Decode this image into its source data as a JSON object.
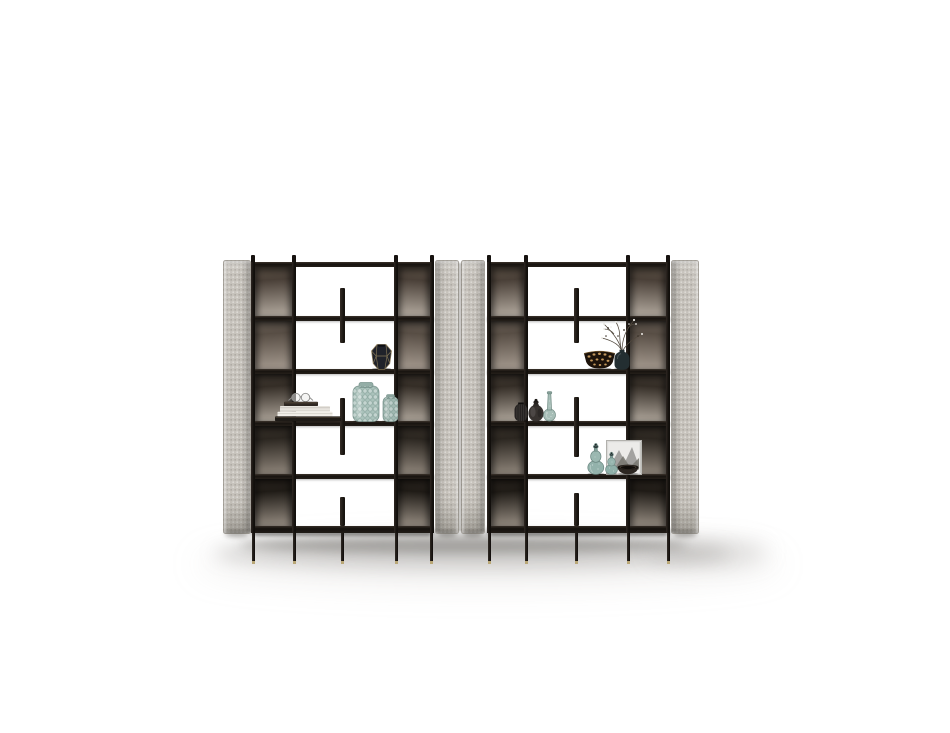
{
  "meta": {
    "description": "Product render on a white background: two tall open-shelf bookcase units with light grey upholstered side panels, black metal frames, smoked-bronze back panels and decorative objects on the shelves."
  },
  "palette": {
    "background": "#ffffff",
    "frame_black": "#1b1714",
    "shelf_dark": "#241f1a",
    "panel_gray": "#c9c5be",
    "panel_gray_edge": "#96928b",
    "leg_gold_tip": "#b9a776",
    "glass_teal": "#a7beb7",
    "bronze_dark": "#3a322a",
    "bronze_light": "#b5aca1"
  },
  "furniture": {
    "stage": {
      "width": 950,
      "height": 733
    },
    "shared": {
      "top_stub_y": 255,
      "beam_y": 262,
      "beam_h": 5,
      "shelf_ys": [
        316,
        369,
        421,
        474
      ],
      "shelf_h": 5,
      "bottom_shelf_y": 526,
      "bottom_shelf_h": 7,
      "panel_top": 260,
      "panel_bottom": 534,
      "leg_top": 533,
      "leg_h": 28,
      "leg_w": 3,
      "tip_h": 2.5,
      "bronze_rows": [
        {
          "from": "#6a5d50",
          "mid": "#4a4038",
          "to": "#b7aea3"
        },
        {
          "from": "#756a5f",
          "mid": "#584e45",
          "to": "#a89d92"
        },
        {
          "from": "#4a4138",
          "mid": "#352e27",
          "to": "#b4aba0"
        },
        {
          "from": "#403830",
          "mid": "#2c2721",
          "to": "#948a7f"
        },
        {
          "from": "#332c25",
          "mid": "#201c17",
          "to": "#9b9186"
        }
      ]
    },
    "units": [
      {
        "id": "left",
        "outer_panel": {
          "x": 223,
          "w": 28,
          "side": "left"
        },
        "inner_panel": {
          "x": 435,
          "w": 24,
          "side": "right"
        },
        "posts": [
          {
            "x": 251,
            "w": 4
          },
          {
            "x": 292,
            "w": 4
          },
          {
            "x": 394,
            "w": 4
          },
          {
            "x": 430,
            "w": 4
          }
        ],
        "bronze_bays": [
          {
            "x": 255,
            "w": 37,
            "ang": 176
          },
          {
            "x": 398,
            "w": 32,
            "ang": 184
          }
        ],
        "fin": {
          "x": 340,
          "w": 5,
          "segments": [
            [
              288,
              343
            ],
            [
              398,
              455
            ],
            [
              497,
              526
            ]
          ]
        },
        "legs": [
          252,
          293,
          341,
          395,
          430
        ]
      },
      {
        "id": "right",
        "outer_panel": {
          "x": 671,
          "w": 28,
          "side": "right"
        },
        "inner_panel": {
          "x": 461,
          "w": 24,
          "side": "left"
        },
        "posts": [
          {
            "x": 487,
            "w": 4
          },
          {
            "x": 524,
            "w": 4
          },
          {
            "x": 626,
            "w": 4
          },
          {
            "x": 666,
            "w": 4
          }
        ],
        "bronze_bays": [
          {
            "x": 491,
            "w": 33,
            "ang": 176
          },
          {
            "x": 630,
            "w": 36,
            "ang": 184
          }
        ],
        "fin": {
          "x": 574,
          "w": 5,
          "segments": [
            [
              288,
              343
            ],
            [
              397,
              457
            ],
            [
              493,
              526
            ]
          ]
        },
        "legs": [
          488,
          525,
          575,
          627,
          667
        ]
      }
    ],
    "floor_shadows": [
      {
        "x": 196,
        "y": 542,
        "w": 584,
        "h": 44,
        "c": "rgba(165,162,157,0.16)",
        "blur": 16
      },
      {
        "x": 214,
        "y": 538,
        "w": 516,
        "h": 30,
        "c": "rgba(105,102,96,0.28)",
        "blur": 9
      },
      {
        "x": 240,
        "y": 536,
        "w": 448,
        "h": 17,
        "c": "rgba(72,69,64,0.36)",
        "blur": 5
      },
      {
        "x": 648,
        "y": 540,
        "w": 120,
        "h": 24,
        "c": "rgba(130,127,121,0.24)",
        "blur": 11
      }
    ]
  },
  "items": [
    {
      "type": "gem-vase",
      "name": "faceted-vase",
      "x": 370,
      "y": 344,
      "w": 23,
      "h": 26
    },
    {
      "type": "book-stack",
      "name": "book-stack-with-glasses",
      "x": 275,
      "y": 389,
      "w": 66,
      "h": 33
    },
    {
      "type": "textured-vase-pair",
      "name": "textured-glass-vases",
      "x": 352,
      "y": 382,
      "w": 46,
      "h": 40
    },
    {
      "type": "patterned-bowl",
      "name": "leopard-print-bowl",
      "x": 583,
      "y": 349,
      "w": 33,
      "h": 21
    },
    {
      "type": "branch-vase",
      "name": "vase-with-branches",
      "x": 595,
      "y": 312,
      "w": 52,
      "h": 58
    },
    {
      "type": "pleated-vase",
      "name": "pleated-dark-vase",
      "x": 514,
      "y": 402,
      "w": 14,
      "h": 20
    },
    {
      "type": "gourd-jug",
      "name": "dark-gourd-jug",
      "x": 528,
      "y": 398,
      "w": 16,
      "h": 24
    },
    {
      "type": "teal-bottle",
      "name": "teal-bottle-vase",
      "x": 543,
      "y": 391,
      "w": 13,
      "h": 31
    },
    {
      "type": "art-frame",
      "name": "framed-artwork",
      "x": 606,
      "y": 440,
      "w": 36,
      "h": 35
    },
    {
      "type": "dark-bowl",
      "name": "dark-bowl",
      "x": 617,
      "y": 464,
      "w": 22,
      "h": 11
    },
    {
      "type": "teal-gourd-pair",
      "name": "teal-gourd-vases",
      "x": 587,
      "y": 443,
      "w": 31,
      "h": 32
    }
  ]
}
